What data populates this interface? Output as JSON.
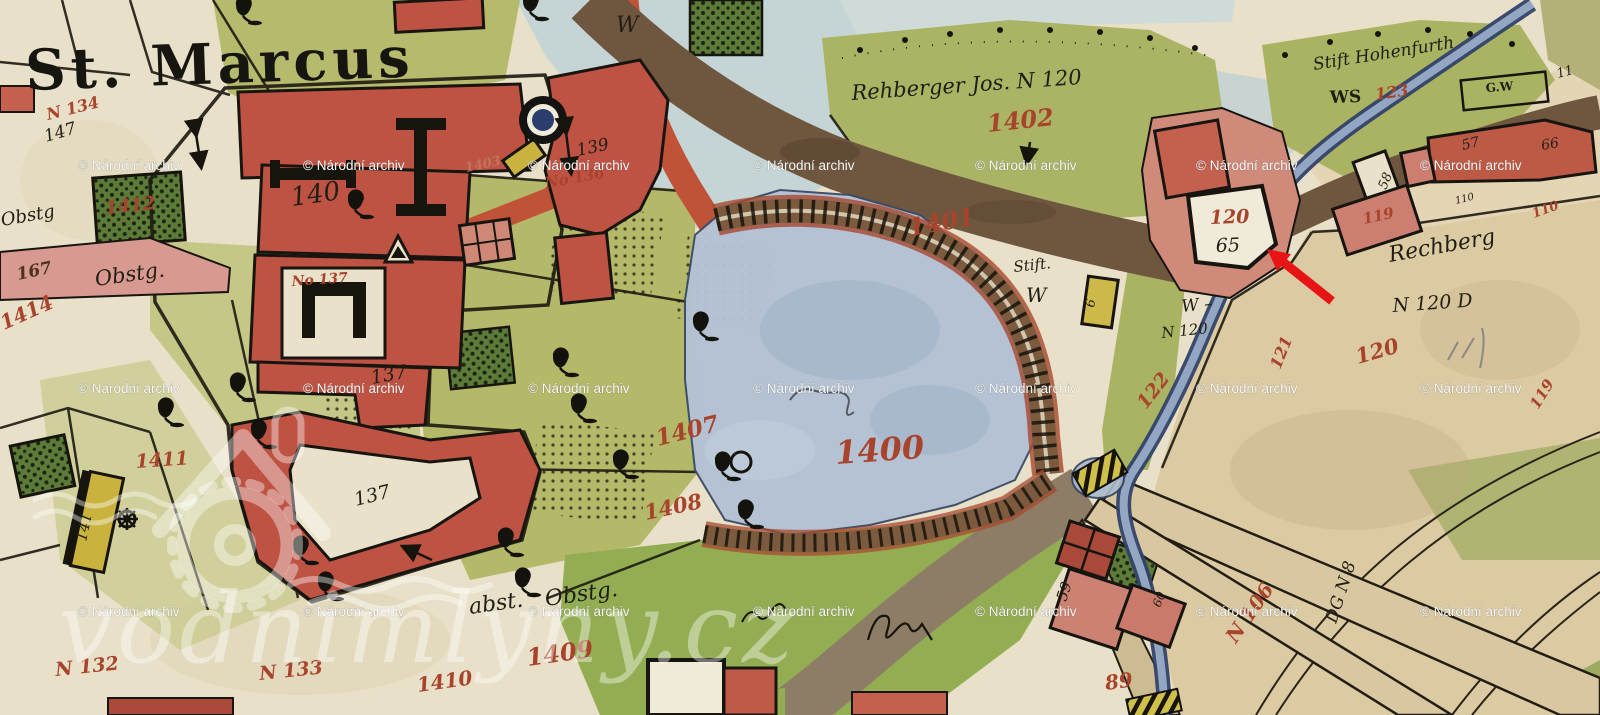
{
  "title": "St. Marcus",
  "palette": {
    "paper": "#e8e0c8",
    "field_tan": "#dccaa2",
    "orchard_green": "#b4ba6a",
    "meadow_green": "#93ad53",
    "dark_garden_green": "#5c7a38",
    "pond_blue": "#b3c2d4",
    "river_blue": "#32426a",
    "pale_blue": "#c5d4d4",
    "road_brown": "#6e563f",
    "road_grey": "#8d7c66",
    "road_red": "#c05238",
    "building_red": "#bf5343",
    "building_pink": "#cf8a7a",
    "highlight_yellow": "#c9b23e",
    "label_red": "#a8432c",
    "ink_black": "#211e15",
    "arrow_red": "#e61414"
  },
  "labels": [
    {
      "id": "title",
      "t": "St. Marcus",
      "x": 26,
      "y": 90,
      "s": 56,
      "r": -2,
      "c": "title"
    },
    {
      "id": "h140",
      "t": "140",
      "x": 292,
      "y": 206,
      "s": 26,
      "r": -8,
      "c": "black"
    },
    {
      "id": "h147",
      "t": "147",
      "x": 46,
      "y": 142,
      "s": 17,
      "r": -16,
      "c": "black"
    },
    {
      "id": "n134",
      "t": "N 134",
      "x": 48,
      "y": 120,
      "s": 16,
      "r": -14,
      "c": "red"
    },
    {
      "id": "p1412",
      "t": "1412",
      "x": 106,
      "y": 214,
      "s": 18,
      "r": -6,
      "c": "red"
    },
    {
      "id": "p1414",
      "t": "1414",
      "x": 4,
      "y": 330,
      "s": 20,
      "r": -24,
      "c": "red"
    },
    {
      "id": "p167",
      "t": "167",
      "x": 18,
      "y": 280,
      "s": 17,
      "r": -12,
      "c": "brown"
    },
    {
      "id": "obstg2",
      "t": "Obstg",
      "x": 2,
      "y": 226,
      "s": 18,
      "r": -10,
      "c": "black"
    },
    {
      "id": "obstg1",
      "t": "Obstg.",
      "x": 96,
      "y": 286,
      "s": 21,
      "r": -8,
      "c": "black"
    },
    {
      "id": "p1411",
      "t": "1411",
      "x": 136,
      "y": 468,
      "s": 19,
      "r": -4,
      "c": "red"
    },
    {
      "id": "h141y",
      "t": "141",
      "x": 86,
      "y": 542,
      "s": 15,
      "r": -78,
      "c": "black"
    },
    {
      "id": "n132",
      "t": "N 132",
      "x": 56,
      "y": 676,
      "s": 19,
      "r": -6,
      "c": "red"
    },
    {
      "id": "n133",
      "t": "N 133",
      "x": 260,
      "y": 680,
      "s": 19,
      "r": -6,
      "c": "red"
    },
    {
      "id": "no137",
      "t": "No 137",
      "x": 292,
      "y": 286,
      "s": 14,
      "r": -4,
      "c": "red"
    },
    {
      "id": "h137a",
      "t": "137",
      "x": 372,
      "y": 384,
      "s": 19,
      "r": -10,
      "c": "black"
    },
    {
      "id": "h137b",
      "t": "137",
      "x": 356,
      "y": 506,
      "s": 19,
      "r": -14,
      "c": "black"
    },
    {
      "id": "p1403",
      "t": "1403",
      "x": 466,
      "y": 172,
      "s": 13,
      "r": -12,
      "c": "faint"
    },
    {
      "id": "h139",
      "t": "139",
      "x": 578,
      "y": 156,
      "s": 17,
      "r": -12,
      "c": "black"
    },
    {
      "id": "no136",
      "t": "No 136",
      "x": 546,
      "y": 188,
      "s": 15,
      "r": -10,
      "c": "red"
    },
    {
      "id": "wTop",
      "t": "W",
      "x": 616,
      "y": 32,
      "s": 22,
      "r": 0,
      "c": "black"
    },
    {
      "id": "rehb",
      "t": "Rehberger Jos. N 120",
      "x": 852,
      "y": 100,
      "s": 21,
      "r": -4,
      "c": "black"
    },
    {
      "id": "p1402",
      "t": "1402",
      "x": 988,
      "y": 132,
      "s": 24,
      "r": -6,
      "c": "red"
    },
    {
      "id": "p1401",
      "t": "1401",
      "x": 910,
      "y": 236,
      "s": 24,
      "r": -10,
      "c": "red"
    },
    {
      "id": "stift",
      "t": "Stift.",
      "x": 1014,
      "y": 272,
      "s": 15,
      "r": -6,
      "c": "black"
    },
    {
      "id": "stiftW",
      "t": "W",
      "x": 1026,
      "y": 302,
      "s": 20,
      "r": 0,
      "c": "black"
    },
    {
      "id": "p1400",
      "t": "1400",
      "x": 836,
      "y": 464,
      "s": 32,
      "r": -4,
      "c": "red"
    },
    {
      "id": "p1407",
      "t": "1407",
      "x": 658,
      "y": 446,
      "s": 23,
      "r": -14,
      "c": "red"
    },
    {
      "id": "p1408",
      "t": "1408",
      "x": 646,
      "y": 520,
      "s": 21,
      "r": -12,
      "c": "red"
    },
    {
      "id": "p1409",
      "t": "1409",
      "x": 528,
      "y": 666,
      "s": 24,
      "r": -8,
      "c": "red"
    },
    {
      "id": "p1410",
      "t": "1410",
      "x": 418,
      "y": 692,
      "s": 20,
      "r": -8,
      "c": "red"
    },
    {
      "id": "abstg",
      "t": "abst.",
      "x": 470,
      "y": 614,
      "s": 22,
      "r": -8,
      "c": "black"
    },
    {
      "id": "obstg3",
      "t": "Obstg.",
      "x": 546,
      "y": 606,
      "s": 22,
      "r": -8,
      "c": "black"
    },
    {
      "id": "hohen",
      "t": "Stift Hohenfurth",
      "x": 1314,
      "y": 70,
      "s": 17,
      "r": -9,
      "c": "black"
    },
    {
      "id": "ws",
      "t": "WS",
      "x": 1330,
      "y": 103,
      "s": 17,
      "r": -2,
      "c": "black",
      "p": 1
    },
    {
      "id": "p123",
      "t": "123",
      "x": 1376,
      "y": 100,
      "s": 16,
      "r": -8,
      "c": "red"
    },
    {
      "id": "gw",
      "t": "G.W",
      "x": 1486,
      "y": 92,
      "s": 12,
      "r": -4,
      "c": "black",
      "p": 1
    },
    {
      "id": "h11",
      "t": "11",
      "x": 1558,
      "y": 78,
      "s": 13,
      "r": -15,
      "c": "black"
    },
    {
      "id": "h57",
      "t": "57",
      "x": 1463,
      "y": 150,
      "s": 14,
      "r": -14,
      "c": "black"
    },
    {
      "id": "h66",
      "t": "66",
      "x": 1542,
      "y": 150,
      "s": 14,
      "r": -10,
      "c": "black"
    },
    {
      "id": "h58",
      "t": "58",
      "x": 1386,
      "y": 190,
      "s": 13,
      "r": -68,
      "c": "black"
    },
    {
      "id": "h110s",
      "t": "110",
      "x": 1456,
      "y": 204,
      "s": 10,
      "r": -14,
      "c": "black"
    },
    {
      "id": "p119a",
      "t": "119",
      "x": 1364,
      "y": 224,
      "s": 15,
      "r": -12,
      "c": "red"
    },
    {
      "id": "p110",
      "t": "110",
      "x": 1534,
      "y": 218,
      "s": 13,
      "r": -20,
      "c": "red"
    },
    {
      "id": "b120",
      "t": "120",
      "x": 1210,
      "y": 224,
      "s": 19,
      "r": -2,
      "c": "red"
    },
    {
      "id": "h65b",
      "t": "65",
      "x": 1216,
      "y": 252,
      "s": 19,
      "r": -2,
      "c": "black"
    },
    {
      "id": "w120w",
      "t": "W –",
      "x": 1182,
      "y": 312,
      "s": 17,
      "r": -6,
      "c": "black"
    },
    {
      "id": "n120a",
      "t": "N 120",
      "x": 1162,
      "y": 338,
      "s": 15,
      "r": -6,
      "c": "black"
    },
    {
      "id": "p122",
      "t": "122",
      "x": 1146,
      "y": 410,
      "s": 19,
      "r": -52,
      "c": "red"
    },
    {
      "id": "p121",
      "t": "121",
      "x": 1280,
      "y": 370,
      "s": 16,
      "r": -68,
      "c": "red"
    },
    {
      "id": "rechberg",
      "t": "Rechberg",
      "x": 1390,
      "y": 262,
      "s": 22,
      "r": -10,
      "c": "black"
    },
    {
      "id": "n120d",
      "t": "N 120 D",
      "x": 1393,
      "y": 312,
      "s": 19,
      "r": -4,
      "c": "black"
    },
    {
      "id": "p120f",
      "t": "120",
      "x": 1358,
      "y": 364,
      "s": 21,
      "r": -16,
      "c": "red"
    },
    {
      "id": "p119b",
      "t": "119",
      "x": 1538,
      "y": 410,
      "s": 15,
      "r": -58,
      "c": "red"
    },
    {
      "id": "h6y",
      "t": "6",
      "x": 1094,
      "y": 308,
      "s": 13,
      "r": -80,
      "c": "black"
    },
    {
      "id": "h59",
      "t": "59",
      "x": 1066,
      "y": 602,
      "s": 15,
      "r": -72,
      "c": "black"
    },
    {
      "id": "h60",
      "t": "60",
      "x": 1160,
      "y": 608,
      "s": 12,
      "r": -68,
      "c": "black"
    },
    {
      "id": "n106",
      "t": "N 106",
      "x": 1236,
      "y": 644,
      "s": 20,
      "r": -55,
      "c": "red"
    },
    {
      "id": "p89",
      "t": "89",
      "x": 1106,
      "y": 690,
      "s": 20,
      "r": -8,
      "c": "red"
    },
    {
      "id": "dgn8",
      "t": "DG N 8",
      "x": 1336,
      "y": 624,
      "s": 17,
      "r": -72,
      "c": "black"
    }
  ],
  "symbols": {
    "trees": [
      [
        165,
        418
      ],
      [
        237,
        393
      ],
      [
        258,
        440
      ],
      [
        300,
        556
      ],
      [
        325,
        592
      ],
      [
        505,
        548
      ],
      [
        522,
        588
      ],
      [
        560,
        368
      ],
      [
        578,
        414
      ],
      [
        620,
        470
      ],
      [
        700,
        332
      ],
      [
        722,
        472
      ],
      [
        745,
        520
      ],
      [
        243,
        16
      ],
      [
        530,
        12
      ],
      [
        355,
        210
      ]
    ],
    "waterwheel": [
      [
        127,
        519
      ]
    ]
  },
  "watermarks": {
    "archive": {
      "text": "© Národní archiv",
      "cols": [
        78,
        303,
        528,
        753,
        975,
        1196,
        1420
      ],
      "rows": [
        170,
        393,
        616
      ]
    },
    "site": {
      "text": "vodnimlyny.cz"
    }
  },
  "annotation_arrow": {
    "color": "#e61414",
    "tail_x": 1332,
    "tail_y": 301,
    "tip_x": 1267,
    "tip_y": 249
  }
}
